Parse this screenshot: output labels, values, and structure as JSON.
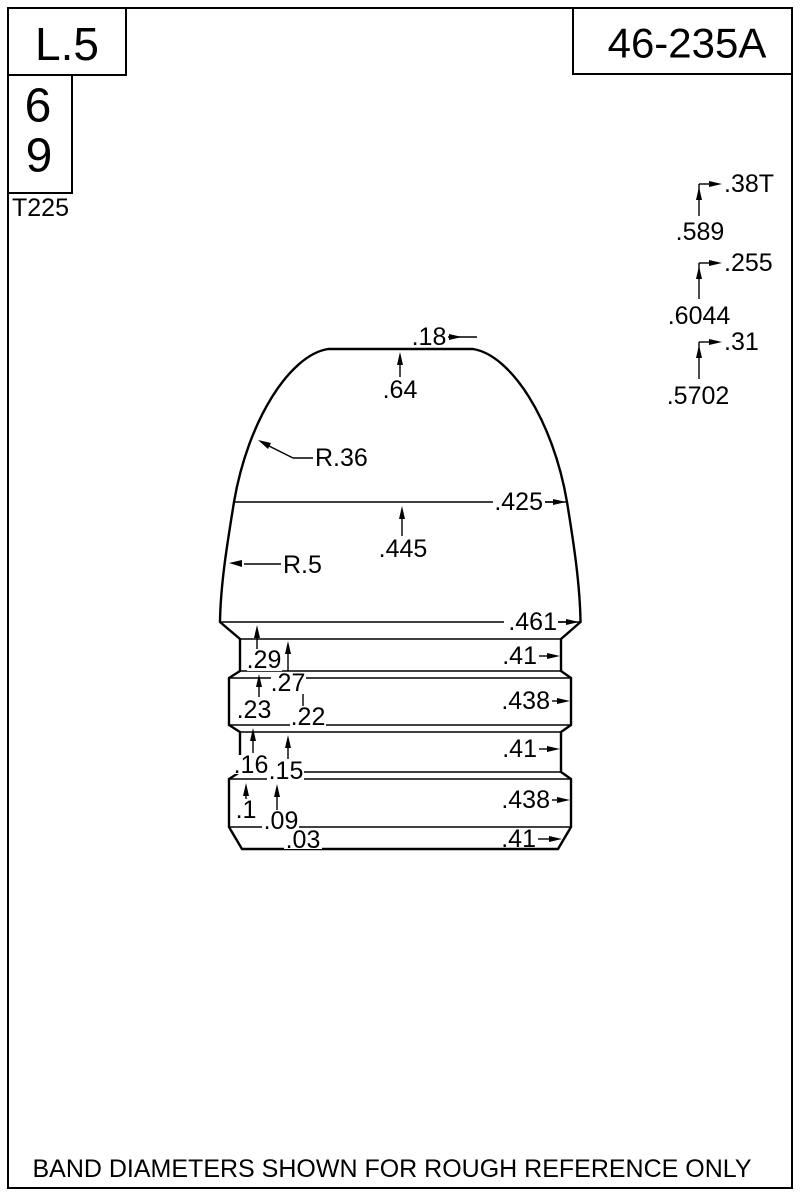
{
  "drawing": {
    "footer_note": "BAND DIAMETERS SHOWN FOR ROUGH REFERENCE ONLY",
    "title_block": {
      "length_code": "L.5",
      "cavity_top": "6",
      "cavity_bottom": "9",
      "template_code": "T225",
      "design_number": "46-235A"
    },
    "right_stack": [
      {
        "label": ".38T",
        "value": ".589"
      },
      {
        "label": ".255",
        "value": ".6044"
      },
      {
        "label": ".31",
        "value": ".5702"
      }
    ],
    "nose_dims": {
      "meplat": ".18",
      "nose_length": ".64",
      "upper_radius": "R.36",
      "ogive_diameter": ".425",
      "ogive_length": ".445",
      "lower_radius": "R.5"
    },
    "body_dims": {
      "shoulder_diameter": ".461",
      "left_lengths": [
        ".29",
        ".27",
        ".23",
        ".22",
        ".16",
        ".15",
        ".1",
        ".09",
        ".03"
      ],
      "right_diameters": [
        ".41",
        ".438",
        ".41",
        ".438",
        ".41"
      ]
    },
    "colors": {
      "ink": "#000000",
      "paper": "#ffffff"
    }
  }
}
